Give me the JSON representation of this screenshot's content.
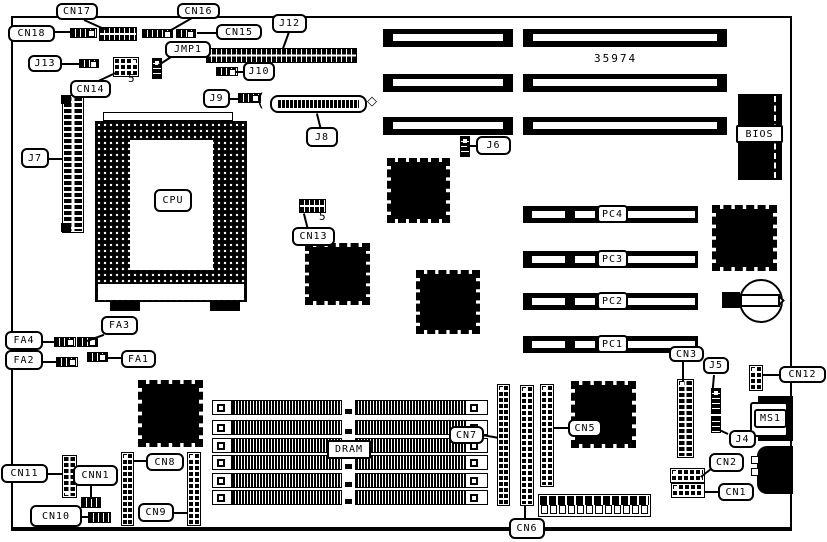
{
  "colors": {
    "ink": "#000000",
    "paper": "#ffffff"
  },
  "board": {
    "part_number": "35974",
    "labels": {
      "cn17": "CN17",
      "cn16": "CN16",
      "cn18": "CN18",
      "cn15": "CN15",
      "j12": "J12",
      "jmp1": "JMP1",
      "j13": "J13",
      "j10": "J10",
      "cn14": "CN14",
      "j9": "J9",
      "j8": "J8",
      "j7": "J7",
      "j6": "J6",
      "cpu": "CPU",
      "cn13": "CN13",
      "bios": "BIOS",
      "pc4": "PC4",
      "pc3": "PC3",
      "pc2": "PC2",
      "pc1": "PC1",
      "fa4": "FA4",
      "fa3": "FA3",
      "fa2": "FA2",
      "fa1": "FA1",
      "cn11": "CN11",
      "cnn1": "CNN1",
      "cn10": "CN10",
      "cn8": "CN8",
      "cn9": "CN9",
      "dram": "DRAM",
      "cn7": "CN7",
      "cn6": "CN6",
      "cn5": "CN5",
      "cn3": "CN3",
      "j5": "J5",
      "j4": "J4",
      "cn12": "CN12",
      "ms1": "MS1",
      "cn2": "CN2",
      "cn1": "CN1",
      "cn14_pin5": "5",
      "cn13_pin5": "5"
    },
    "icons": {
      "j8_bracket_left": "(",
      "j8_end_diamond": "◇"
    }
  }
}
